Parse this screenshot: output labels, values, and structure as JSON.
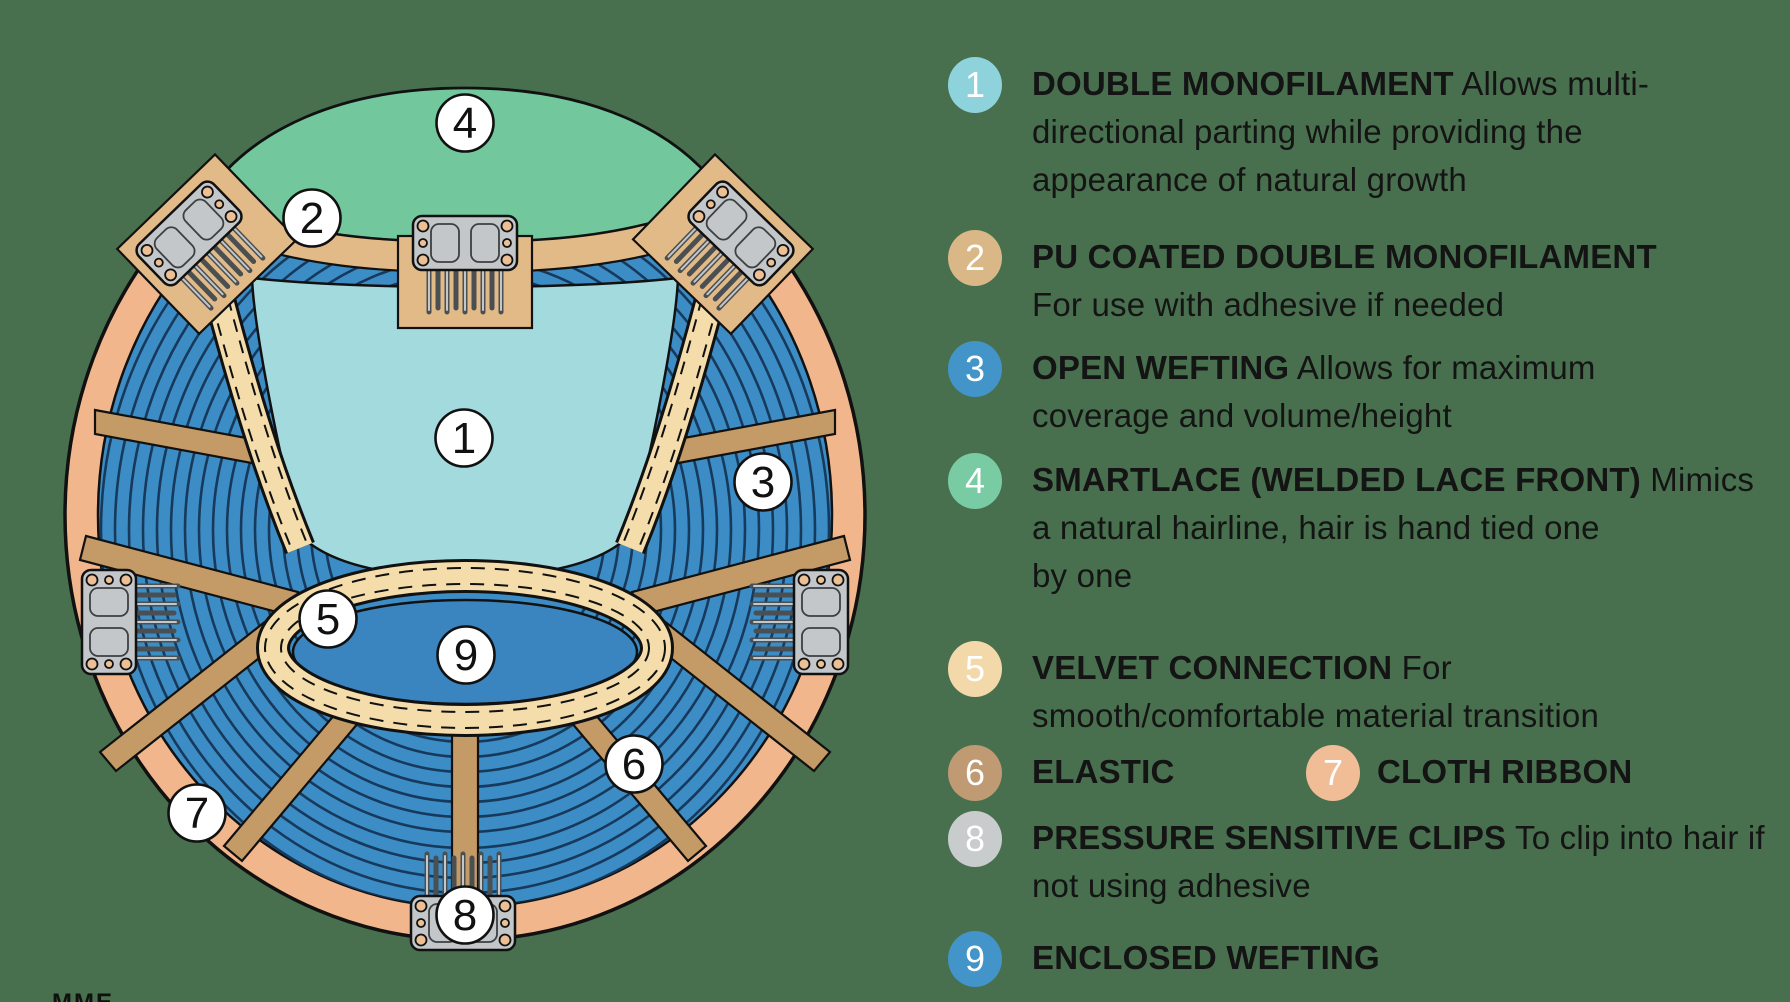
{
  "page": {
    "background": "#48704e"
  },
  "footer": {
    "partial_text": "MME"
  },
  "diagram": {
    "colors": {
      "outline": "#111111",
      "ring": "#f2b68d",
      "weft": "#3c8dc5",
      "weft_line": "#17395c",
      "teal": "#a3dade",
      "green": "#72c89c",
      "band": "#e2ba88",
      "spoke": "#c49a66",
      "velvet": "#f4dcab",
      "area9": "#3a85bf",
      "clip": "#c3c7c9",
      "clip_hole": "#ecc094",
      "badge_fill": "#ffffff"
    },
    "callouts": {
      "c1": "1",
      "c2": "2",
      "c3": "3",
      "c4": "4",
      "c5": "5",
      "c6": "6",
      "c7": "7",
      "c8": "8",
      "c9": "9"
    }
  },
  "legend": {
    "items": [
      {
        "num": "1",
        "badge_color": "#8ed3dc",
        "title": "DOUBLE MONOFILAMENT",
        "lines": [
          " Allows multi-",
          "directional parting while providing the",
          "appearance of natural growth"
        ]
      },
      {
        "num": "2",
        "badge_color": "#d9b787",
        "title": "PU COATED DOUBLE MONOFILAMENT",
        "lines": [
          "",
          "For use with adhesive if needed"
        ]
      },
      {
        "num": "3",
        "badge_color": "#4394c8",
        "title": "OPEN WEFTING",
        "lines": [
          " Allows for maximum",
          "coverage and volume/height"
        ]
      },
      {
        "num": "4",
        "badge_color": "#79cba4",
        "title": "SMARTLACE (WELDED LACE FRONT)",
        "lines": [
          "  Mimics",
          "a natural hairline, hair is hand tied one",
          "by one"
        ]
      },
      {
        "num": "5",
        "badge_color": "#f3d9a9",
        "title": "VELVET CONNECTION",
        "lines": [
          " For",
          "smooth/comfortable material transition"
        ]
      },
      {
        "num": "6",
        "badge_color": "#c09a72",
        "title": "ELASTIC",
        "lines": [
          ""
        ]
      },
      {
        "num": "7",
        "badge_color": "#f1bd97",
        "title": "CLOTH RIBBON",
        "lines": [
          ""
        ]
      },
      {
        "num": "8",
        "badge_color": "#c9cccd",
        "title": "PRESSURE SENSITIVE CLIPS",
        "lines": [
          " To clip into hair if",
          "not using adhesive"
        ]
      },
      {
        "num": "9",
        "badge_color": "#4294c9",
        "title": "ENCLOSED WEFTING",
        "lines": [
          ""
        ]
      }
    ]
  }
}
